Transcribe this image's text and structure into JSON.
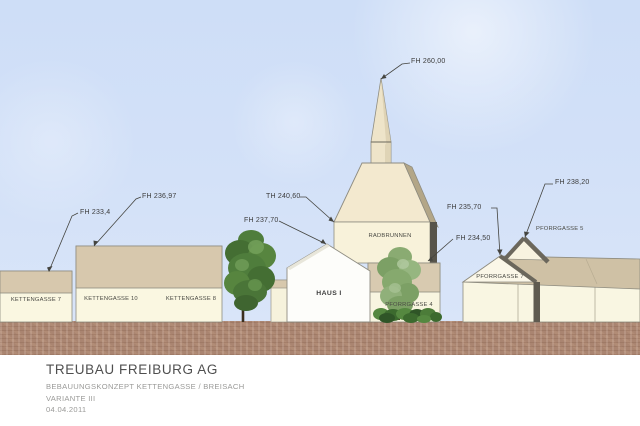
{
  "title_block": {
    "company": "TREUBAU FREIBURG AG",
    "project": "BEBAUUNGSKONZEPT KETTENGASSE / BREISACH",
    "variant": "VARIANTE III",
    "date": "04.04.2011"
  },
  "annotations": {
    "fh_260": "FH 260,00",
    "th_240": "TH 240,60",
    "fh_237": "FH 237,70",
    "fh_233": "FH 233,4",
    "fh_236": "FH 236,97",
    "fh_235": "FH 235,70",
    "fh_234": "FH 234,50",
    "fh_238": "FH 238,20"
  },
  "buildings": {
    "kettengasse7": "KETTENGASSE 7",
    "kettengasse10": "KETTENGASSE 10",
    "kettengasse8": "KETTENGASSE 8",
    "haus1": "HAUS I",
    "radbrunnen": "RADBRUNNEN",
    "pforrgasse4": "PFORRGASSE 4",
    "pforrgasse7": "PFORRGASSE 7",
    "pforrgasse5": "PFORRGASSE 5"
  },
  "colors": {
    "sky": "#d3e1f8",
    "ground": "#aa8571",
    "facade_cream": "#faf7e1",
    "roof_band_tan": "#d7c8ad",
    "church_roof": "#f3e9cf",
    "roof_shadow_dark": "#6b675c",
    "haus1_white": "#fdfdfa",
    "tree_green_dark": "#4f7d3c",
    "tree_green_light": "#8fb078",
    "annotation_line": "#44443f"
  }
}
